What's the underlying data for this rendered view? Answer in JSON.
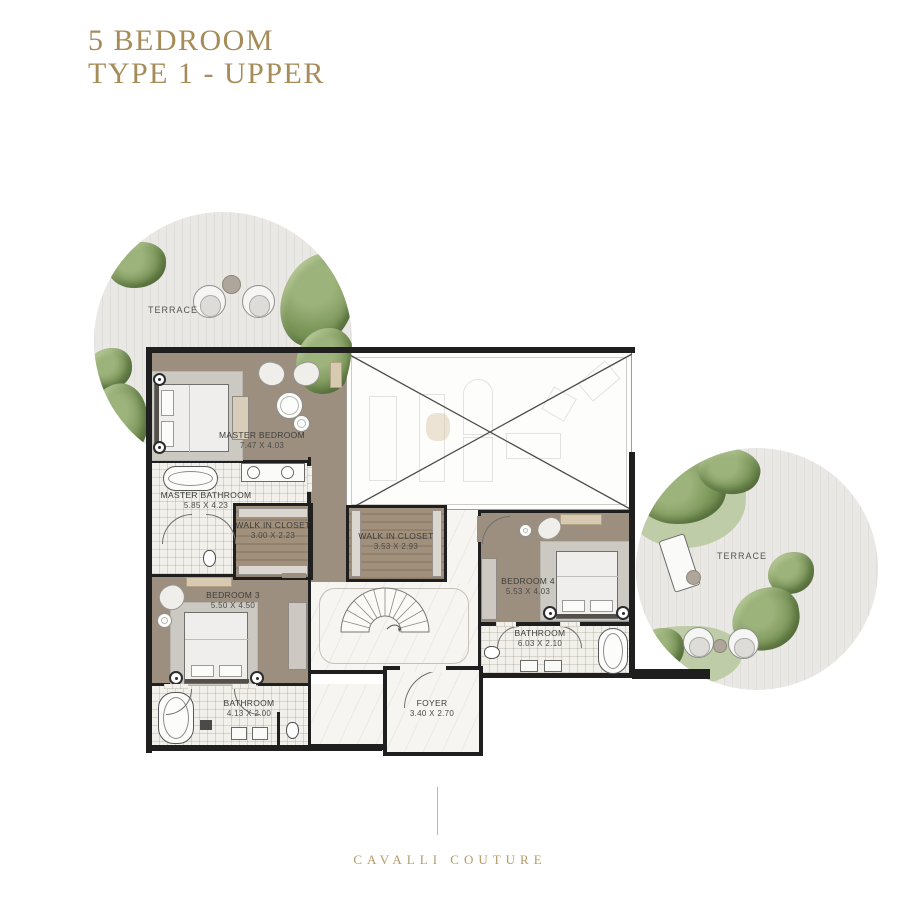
{
  "title": {
    "line1": "5 BEDROOM",
    "line2": "TYPE 1 - UPPER"
  },
  "brand": {
    "name": "CAVALLI COUTURE"
  },
  "plan": {
    "rooms": {
      "terrace_left": {
        "label": "TERRACE"
      },
      "terrace_right": {
        "label": "TERRACE"
      },
      "master_bedroom": {
        "label": "MASTER BEDROOM",
        "dims": "7.47 X 4.03"
      },
      "master_bathroom": {
        "label": "MASTER BATHROOM",
        "dims": "5.85 X 4.23"
      },
      "walk_in_closet_1": {
        "label": "WALK IN CLOSET",
        "dims": "3.00 X 2.23"
      },
      "walk_in_closet_2": {
        "label": "WALK IN CLOSET",
        "dims": "3.53 X 2.93"
      },
      "bedroom_3": {
        "label": "BEDROOM 3",
        "dims": "5.50 X 4.50"
      },
      "bedroom_4": {
        "label": "BEDROOM 4",
        "dims": "5.53 X 4.03"
      },
      "bathroom_3": {
        "label": "BATHROOM",
        "dims": "4.13 X 2.00"
      },
      "bathroom_4": {
        "label": "BATHROOM",
        "dims": "6.03 X 2.10"
      },
      "foyer": {
        "label": "FOYER",
        "dims": "3.40 X 2.70"
      }
    },
    "colors": {
      "accent_gold": "#a58c58",
      "brand_gold": "#b49a67",
      "wall": "#1f1f1f",
      "wood_floor": "#9c8f80",
      "tile_floor": "#f2f0eb",
      "marble_floor": "#f7f5f1",
      "terrace_deck": "#eae8e5",
      "greenery": "#6f8b52"
    }
  }
}
